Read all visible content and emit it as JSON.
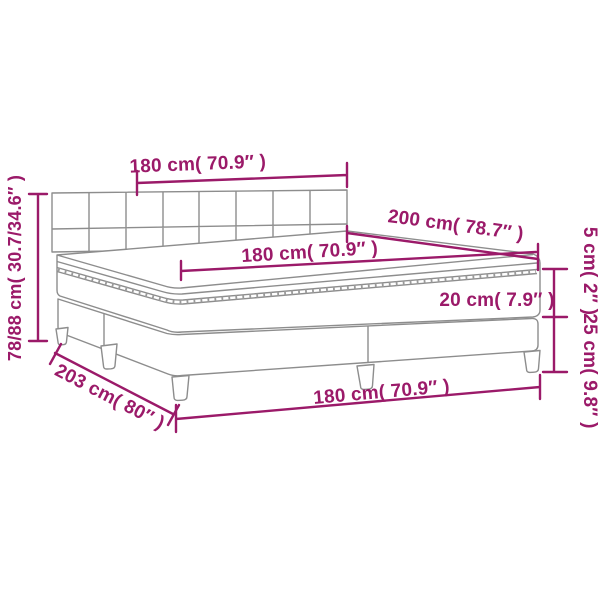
{
  "colors": {
    "dimension_accent": "#9b1a69",
    "drawing_line": "#8d8d8d",
    "background": "#ffffff"
  },
  "measurements": {
    "headboard_width": {
      "label": "180 cm( 70.9″ )",
      "cm": "180",
      "inches": "70.9"
    },
    "side_length": {
      "label": "200 cm( 78.7″ )",
      "cm": "200",
      "inches": "78.7"
    },
    "mattress_width": {
      "label": "180 cm( 70.9″ )",
      "cm": "180",
      "inches": "70.9"
    },
    "topper_thickness": {
      "label": "5 cm( 2″ )",
      "cm": "5",
      "inches": "2"
    },
    "mattress_thickness": {
      "label": "20 cm( 7.9″ )",
      "cm": "20",
      "inches": "7.9"
    },
    "base_height": {
      "label": "25 cm( 9.8″ )",
      "cm": "25",
      "inches": "9.8"
    },
    "overall_height": {
      "label": "78/88 cm( 30.7/34.6″ )",
      "cm": "78/88",
      "inches": "30.7/34.6"
    },
    "overall_length": {
      "label": "203 cm( 80″ )",
      "cm": "203",
      "inches": "80"
    },
    "base_width": {
      "label": "180 cm( 70.9″ )",
      "cm": "180",
      "inches": "70.9"
    }
  }
}
